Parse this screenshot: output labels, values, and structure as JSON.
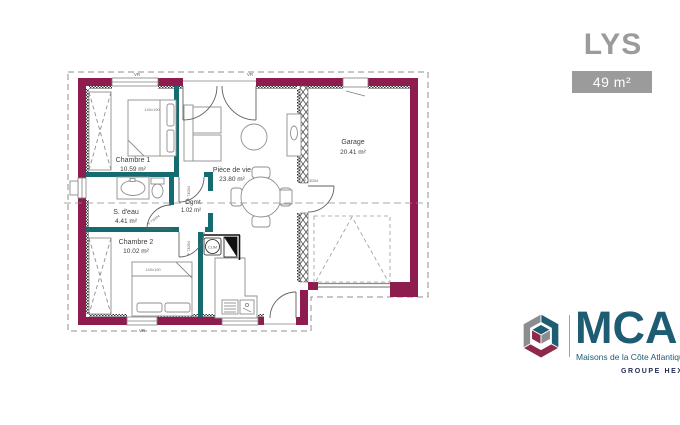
{
  "header": {
    "model_name": "LYS",
    "area_badge": "49 m²"
  },
  "rooms": {
    "chambre1": {
      "name": "Chambre 1",
      "area": "10.59 m²"
    },
    "sdeau": {
      "name": "S. d'eau",
      "area": "4.41 m²"
    },
    "chambre2": {
      "name": "Chambre 2",
      "area": "10.02 m²"
    },
    "degagement": {
      "name": "Dgmt",
      "area": "1.02 m²"
    },
    "piece_de_vie": {
      "name": "Pièce de vie",
      "area": "23.80 m²"
    },
    "garage": {
      "name": "Garage",
      "area": "20.41 m²"
    }
  },
  "annotations": {
    "clim": "CLIM",
    "door_label": "P 73/204",
    "shutter_label": "VR",
    "bed_label": "140x190"
  },
  "logo": {
    "acronym": "MCA",
    "tagline": "Maisons de la Côte Atlantique",
    "group_label": "GROUPE HEXAOM"
  },
  "colors": {
    "exterior_wall": "#8e1c4e",
    "interior_wall": "#156b70",
    "accent_gray": "#9c9b9b",
    "logo_teal": "#1d5c72",
    "logo_red": "#8e2a49",
    "logo_navy": "#232f52"
  }
}
